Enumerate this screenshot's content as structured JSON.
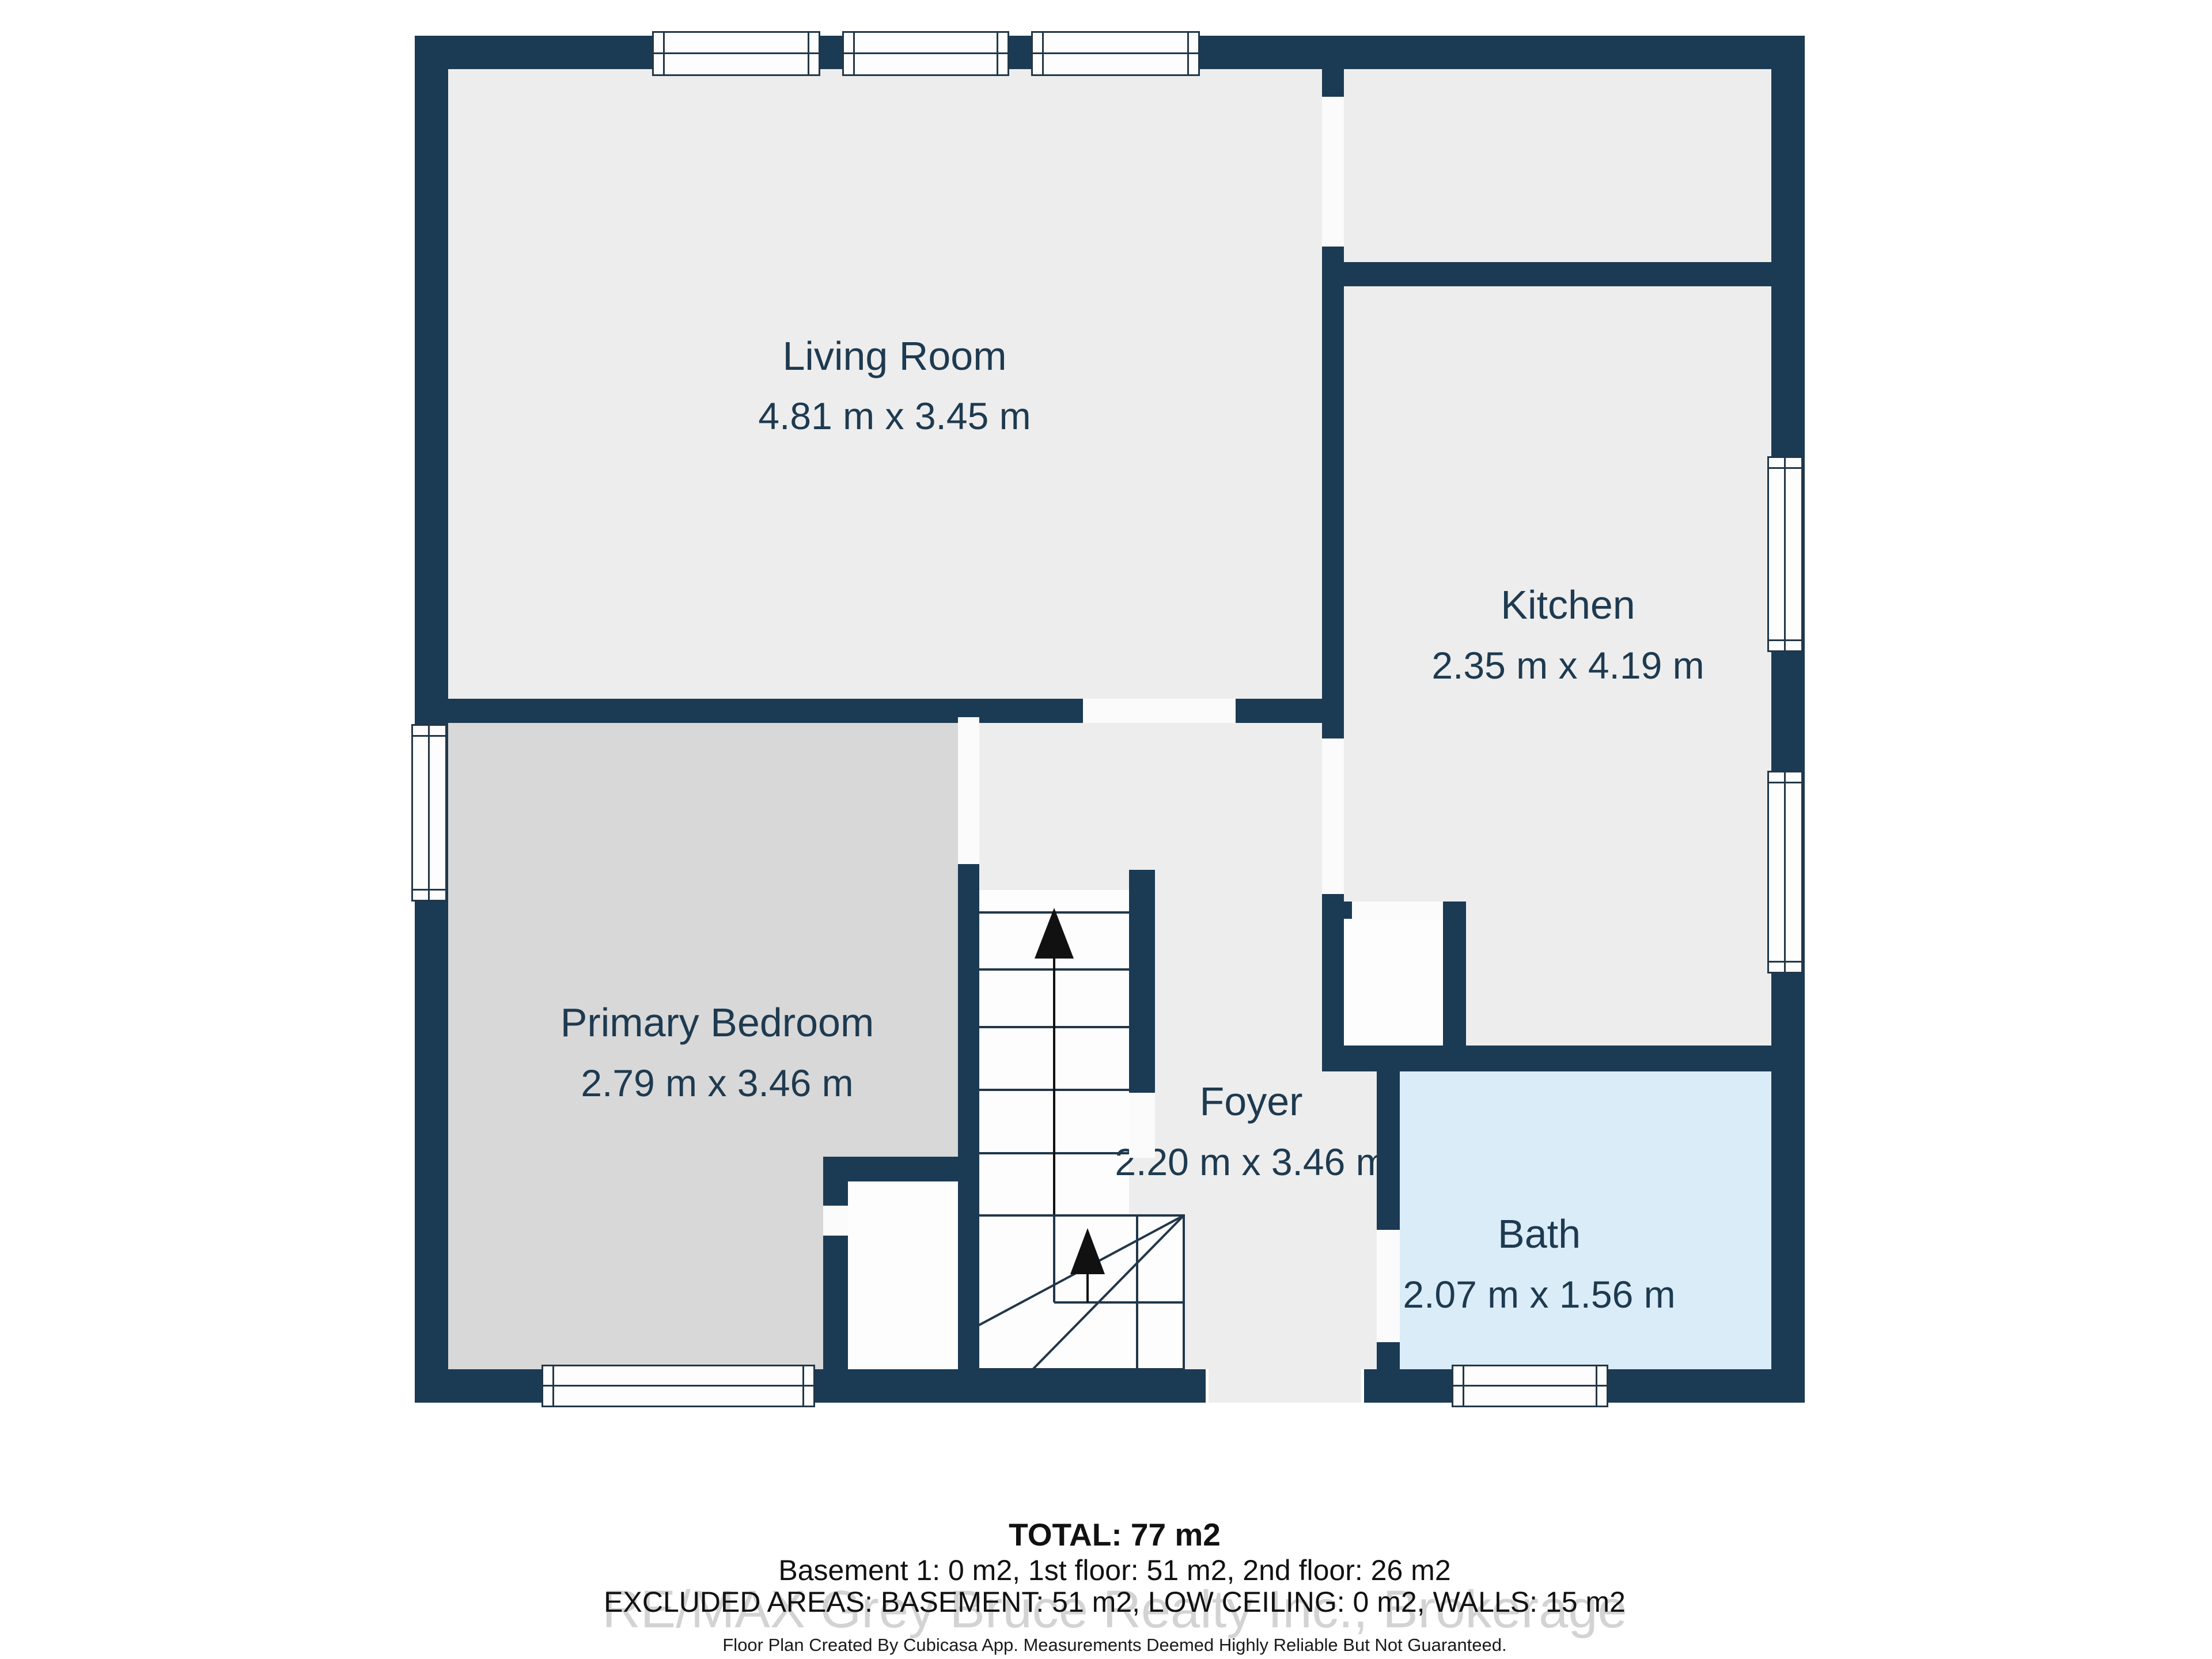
{
  "rooms": {
    "living_room": {
      "name": "Living Room",
      "dims": "4.81 m x 3.45 m"
    },
    "kitchen": {
      "name": "Kitchen",
      "dims": "2.35 m x 4.19 m"
    },
    "primary_bedroom": {
      "name": "Primary Bedroom",
      "dims": "2.79 m x 3.46 m"
    },
    "foyer": {
      "name": "Foyer",
      "dims": "2.20 m x 3.46 m"
    },
    "bath": {
      "name": "Bath",
      "dims": "2.07 m x 1.56 m"
    }
  },
  "footer": {
    "total": "TOTAL: 77 m2",
    "floors": "Basement 1: 0 m2, 1st floor: 51 m2, 2nd floor: 26 m2",
    "excluded": "EXCLUDED AREAS: BASEMENT: 51 m2, LOW CEILING: 0 m2, WALLS: 15 m2",
    "watermark": "RE/MAX Grey Bruce Realty Inc., Brokerage",
    "disclaimer": "Floor Plan Created By Cubicasa App. Measurements Deemed Highly Reliable But Not Guaranteed."
  },
  "colors": {
    "wall": "#1b3a54",
    "floor": "#ededed",
    "bedroom_floor": "#d8d8d8",
    "bath_floor": "#d9ecf8",
    "stairs_and_closets": "#fdfdfd",
    "label_text": "#1e3a50",
    "outline": "#223748"
  },
  "icons": {
    "stairs_up_arrow": "black up arrow on stair runs",
    "window_symbol": "white bar with center glass line",
    "door_opening": "white gap in wall"
  }
}
